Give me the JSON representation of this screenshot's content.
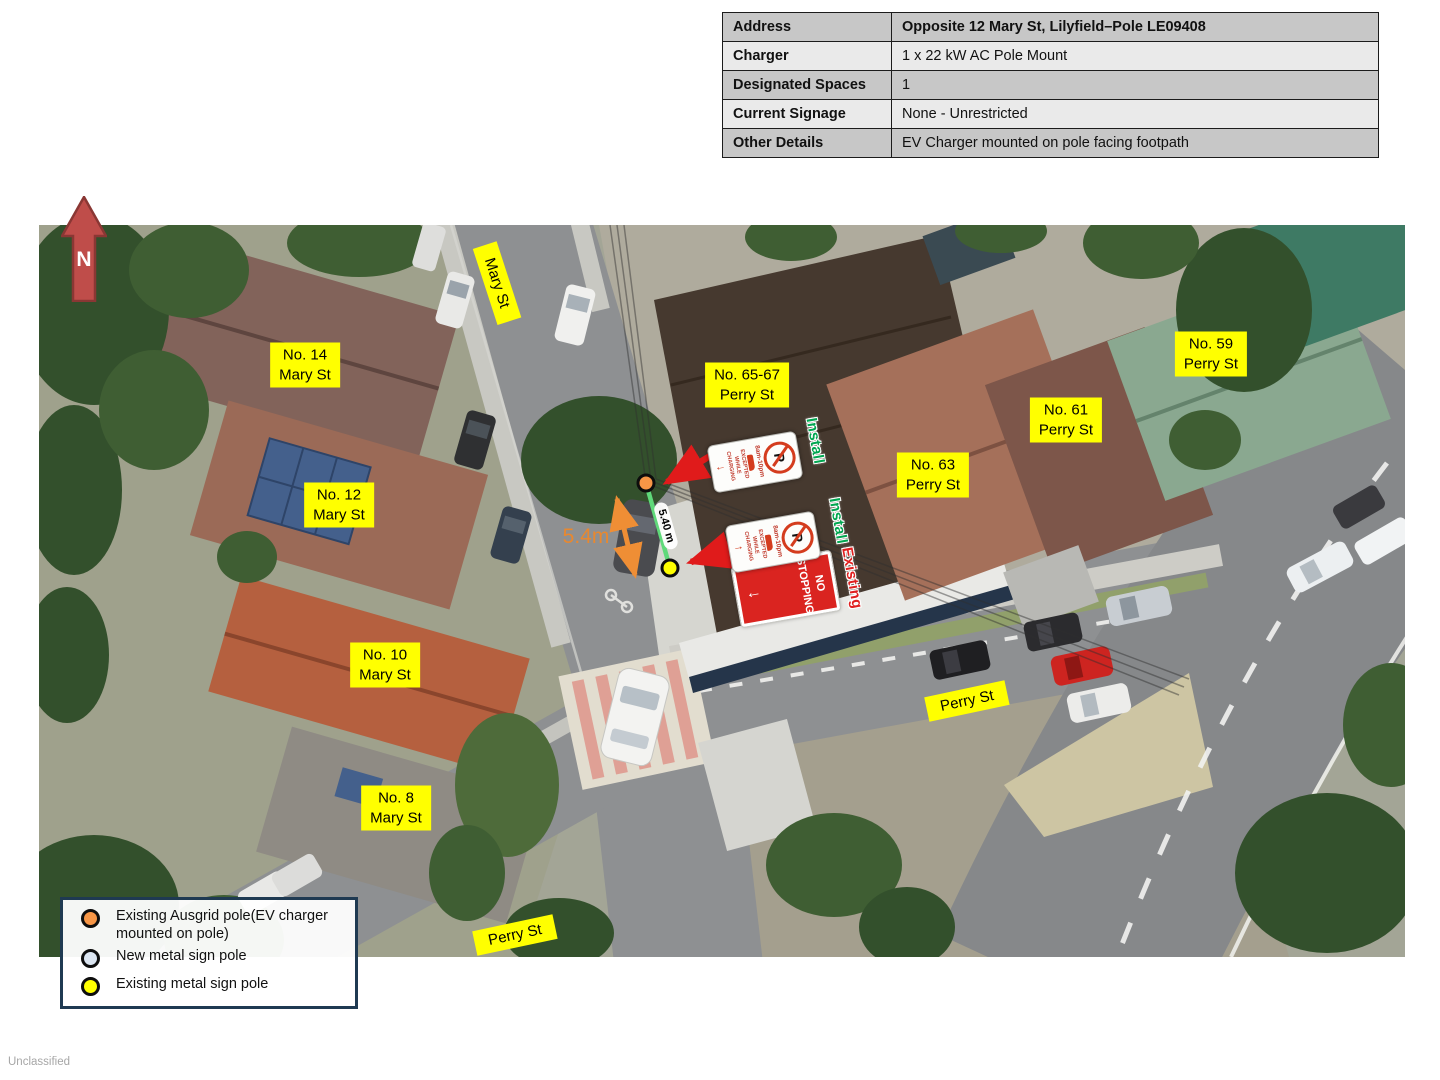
{
  "classification": "Unclassified",
  "north_arrow": {
    "label": "N"
  },
  "info_table": {
    "rows": [
      {
        "label": "Address",
        "value": "Opposite 12 Mary St, Lilyfield–Pole LE09408"
      },
      {
        "label": "Charger",
        "value": "1 x 22 kW AC Pole Mount"
      },
      {
        "label": "Designated Spaces",
        "value": "1"
      },
      {
        "label": "Current Signage",
        "value": "None - Unrestricted"
      },
      {
        "label": "Other Details",
        "value": "EV Charger mounted on pole facing footpath"
      }
    ]
  },
  "map": {
    "house_labels": [
      {
        "line1": "No. 14",
        "line2": "Mary St"
      },
      {
        "line1": "No. 12",
        "line2": "Mary St"
      },
      {
        "line1": "No. 10",
        "line2": "Mary St"
      },
      {
        "line1": "No. 8",
        "line2": "Mary St"
      },
      {
        "line1": "No. 65-67",
        "line2": "Perry St"
      },
      {
        "line1": "No. 63",
        "line2": "Perry St"
      },
      {
        "line1": "No. 61",
        "line2": "Perry St"
      },
      {
        "line1": "No. 59",
        "line2": "Perry St"
      }
    ],
    "street_labels": [
      {
        "text": "Mary St"
      },
      {
        "text": "Perry St"
      },
      {
        "text": "Perry St"
      }
    ],
    "annotations": {
      "install_1": "Install",
      "install_2": "Install",
      "existing": "Existing",
      "distance_line_label": "5.40 m",
      "distance_arrow_label": "5.4m"
    },
    "signs": {
      "p_symbol": "P",
      "hours": "8am-10pm",
      "exception": "EXCEPTED WHILE CHARGING",
      "arrow_down": "↓",
      "arrow_up": "↑",
      "no_stopping": "NO STOPPING"
    }
  },
  "legend": {
    "items": [
      {
        "marker_color": "#f79646",
        "text": "Existing Ausgrid pole(EV charger mounted on pole)"
      },
      {
        "marker_color": "#dbe5f1",
        "text": "New metal sign pole"
      },
      {
        "marker_color": "#ffff00",
        "text": "Existing metal sign pole"
      }
    ]
  },
  "colors": {
    "install_green": "#00a650",
    "existing_red": "#e02020",
    "arrow_red": "#e01b1b",
    "dimension_orange": "#ef8e35",
    "label_yellow": "#ffff00",
    "legend_border": "#1f3a52",
    "pole_orange": "#f79646",
    "pole_new": "#dbe5f1",
    "pole_yellow": "#ffff00"
  }
}
